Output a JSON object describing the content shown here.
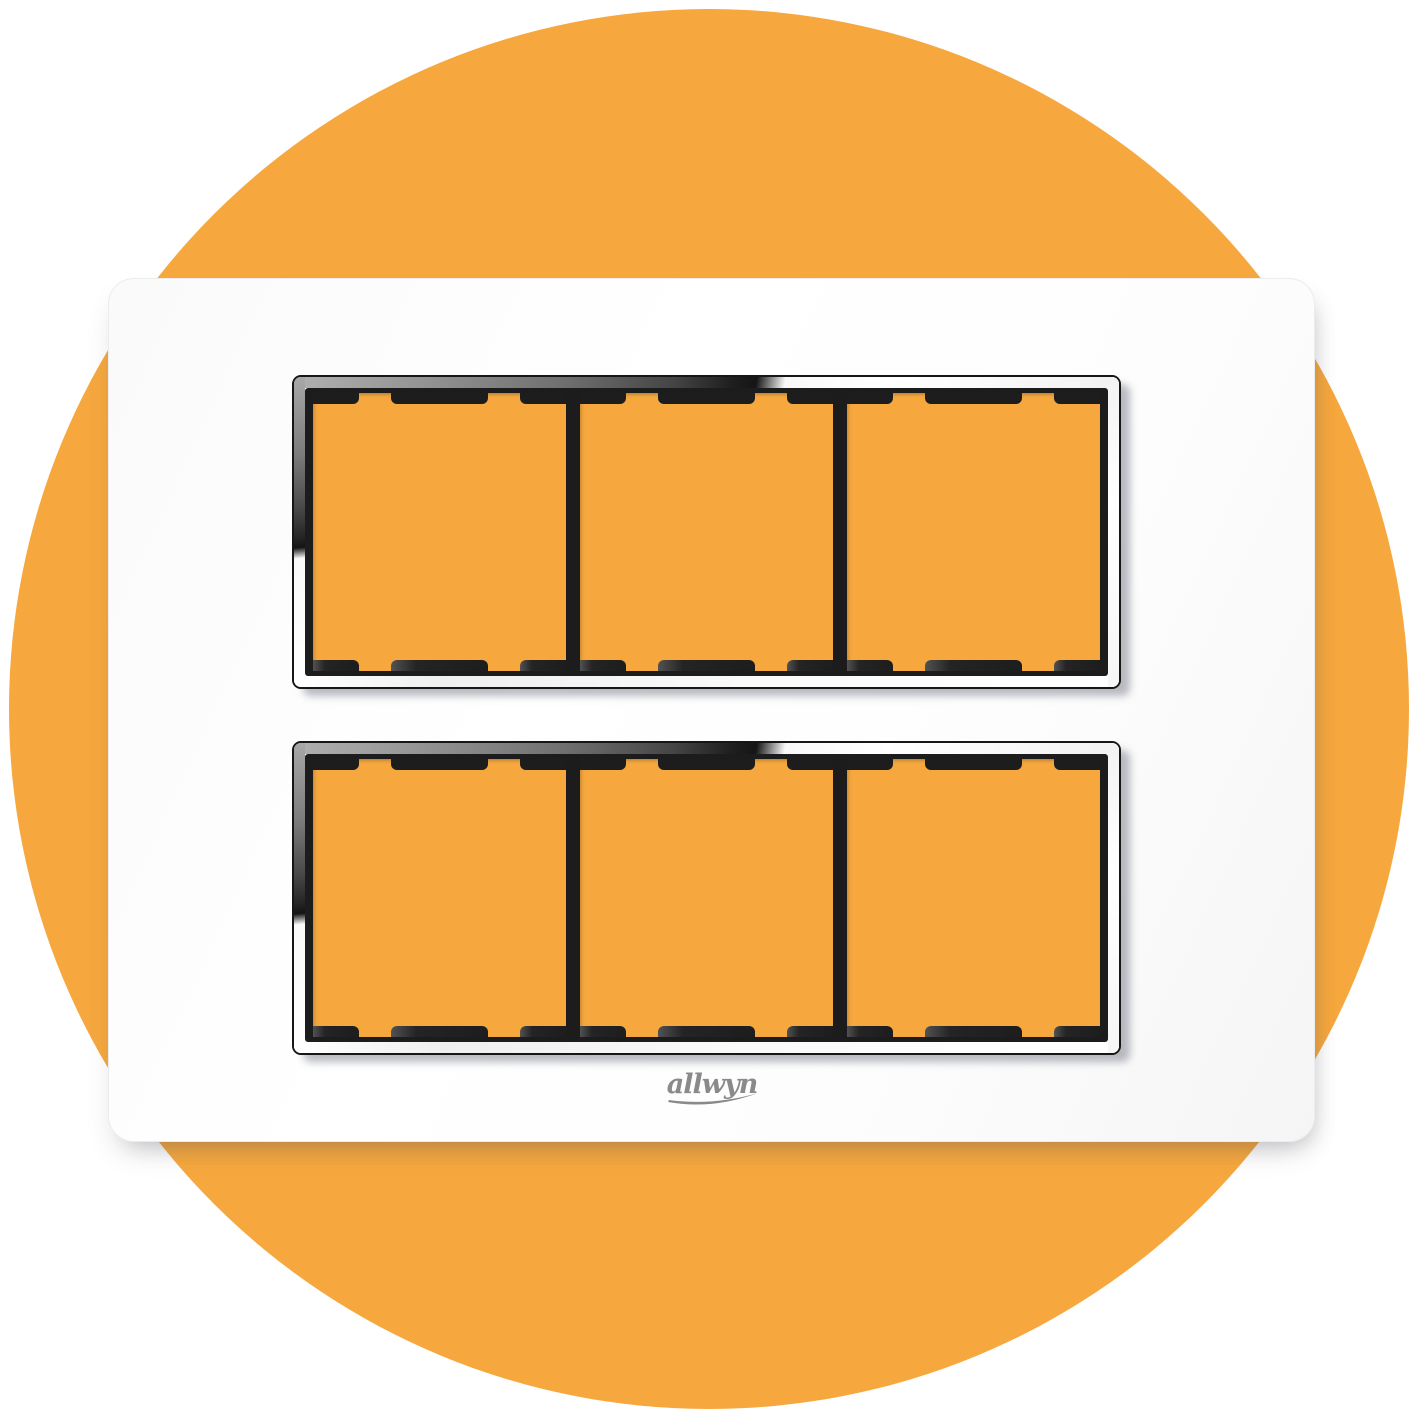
{
  "product": {
    "brand": "allwyn",
    "name": "modular switch plate",
    "rows": 2,
    "modules_per_row": 3,
    "total_module_windows": 6
  },
  "colors": {
    "page_background": "#FFFFFF",
    "circle_orange": "#F6A83E",
    "module_orange": "#F6A83E",
    "plate_white": "#FCFCFC",
    "frame_black": "#1C1C1C",
    "chrome_dark": "#1F1F1F",
    "chrome_light": "#FFFFFF",
    "logo_gray": "#8A8A8A"
  }
}
